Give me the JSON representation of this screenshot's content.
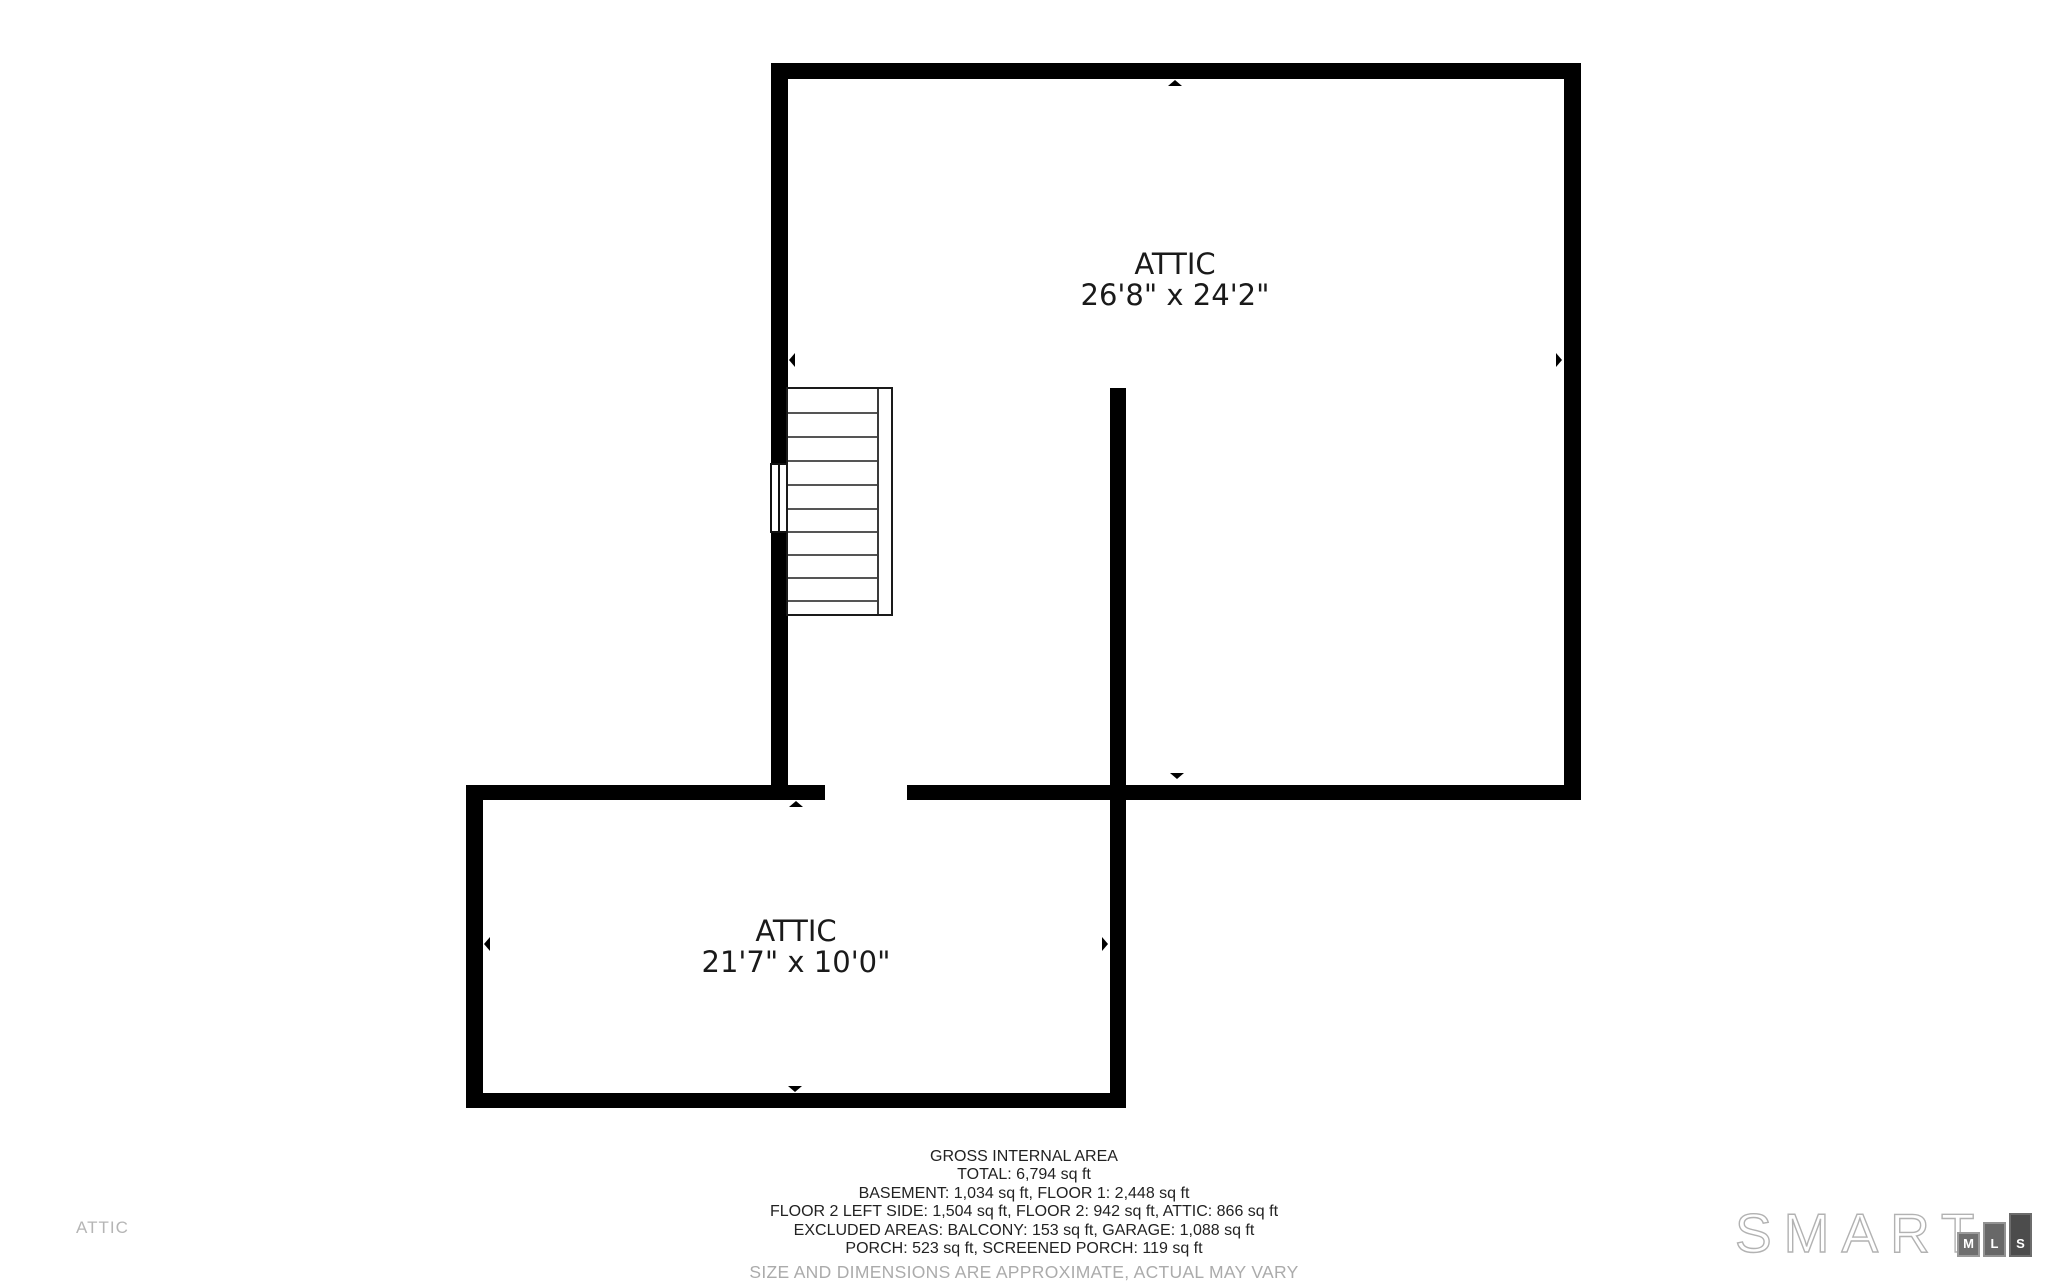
{
  "floorplan": {
    "floor_label": "ATTIC",
    "rooms": [
      {
        "name": "ATTIC",
        "dimensions": "26'8\" x 24'2\""
      },
      {
        "name": "ATTIC",
        "dimensions": "21'7\" x 10'0\""
      }
    ]
  },
  "footer": {
    "lines": [
      "GROSS INTERNAL AREA",
      "TOTAL: 6,794 sq ft",
      "BASEMENT: 1,034 sq ft, FLOOR 1: 2,448 sq ft",
      "FLOOR 2 LEFT SIDE: 1,504 sq ft, FLOOR 2: 942 sq ft, ATTIC: 866 sq ft",
      "EXCLUDED AREAS: BALCONY: 153 sq ft, GARAGE: 1,088 sq ft",
      "PORCH: 523 sq ft, SCREENED PORCH: 119 sq ft"
    ],
    "disclaimer": "SIZE AND DIMENSIONS ARE APPROXIMATE, ACTUAL MAY VARY"
  },
  "branding": {
    "logo_text": "SMART",
    "logo_blocks": [
      "M",
      "L",
      "S"
    ]
  },
  "colors": {
    "wall": "#000000",
    "label_text": "#1a1a1a",
    "muted_text": "#b5b5b5",
    "disclaimer_text": "#ababab",
    "logo_outline": "#b2b2b2",
    "logo_block_m": "#6f6f6f",
    "logo_block_l": "#686868",
    "logo_block_s": "#4c4c4c"
  }
}
